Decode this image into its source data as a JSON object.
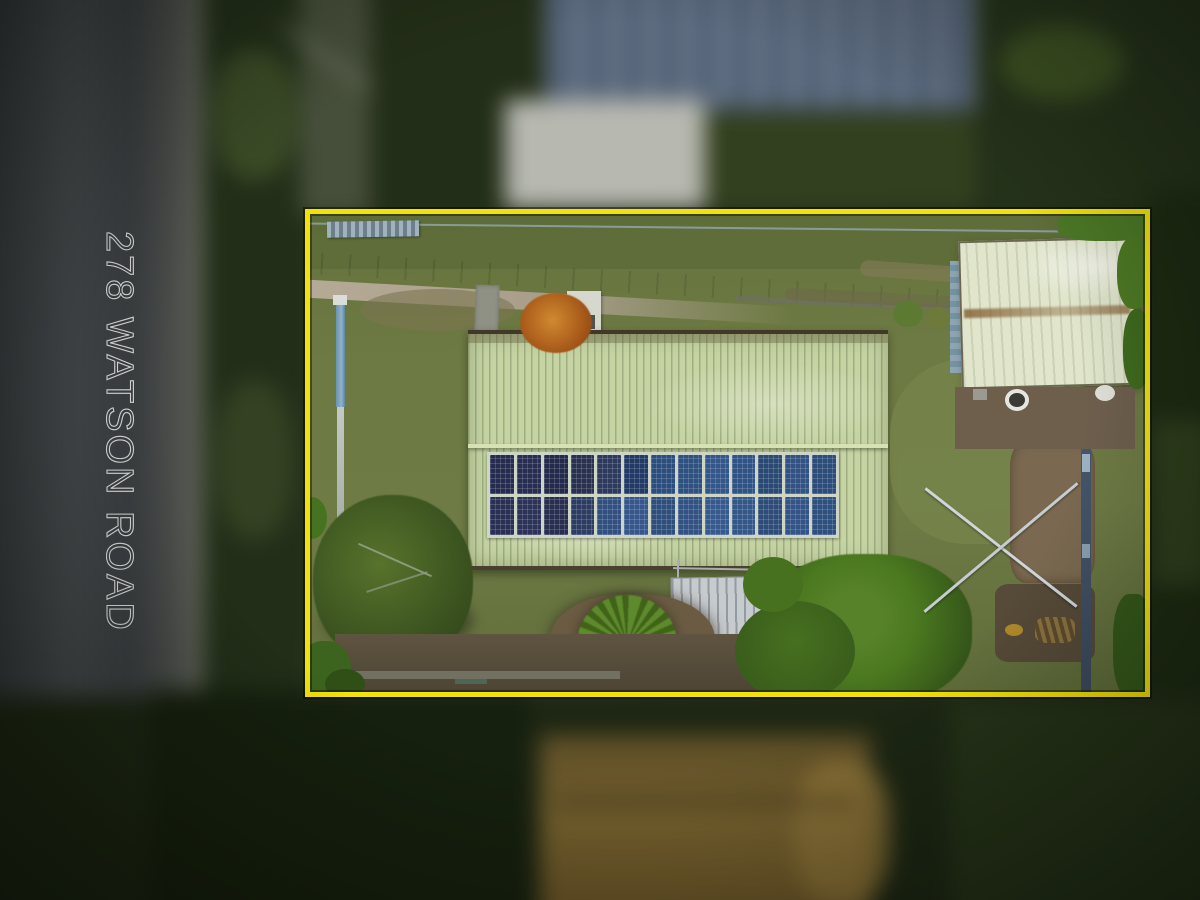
{
  "overlay": {
    "address_label": "278 WATSON ROAD"
  },
  "colors": {
    "boundary": "#f2e10a",
    "address-text": "#dadada",
    "roof": "#c6d4a4",
    "shed": "#e0e5cc",
    "grass": "#6d7a43",
    "panel-frame": "#ccd5c6"
  },
  "solar": {
    "rows": 2,
    "cols": 13,
    "panel_colors": [
      "#262c4f",
      "#282e52",
      "#232a4b",
      "#2a314f",
      "#2d3a5e",
      "#223b66",
      "#2c4e7d",
      "#2e517f",
      "#34578a",
      "#305386",
      "#2a4a74",
      "#315283",
      "#2c4c7a",
      "#2a3054",
      "#2c3258",
      "#272e50",
      "#2d3c62",
      "#315080",
      "#35578b",
      "#2e4e7c",
      "#315282",
      "#365a8e",
      "#335788",
      "#2d4c78",
      "#325486",
      "#2e507e"
    ]
  }
}
